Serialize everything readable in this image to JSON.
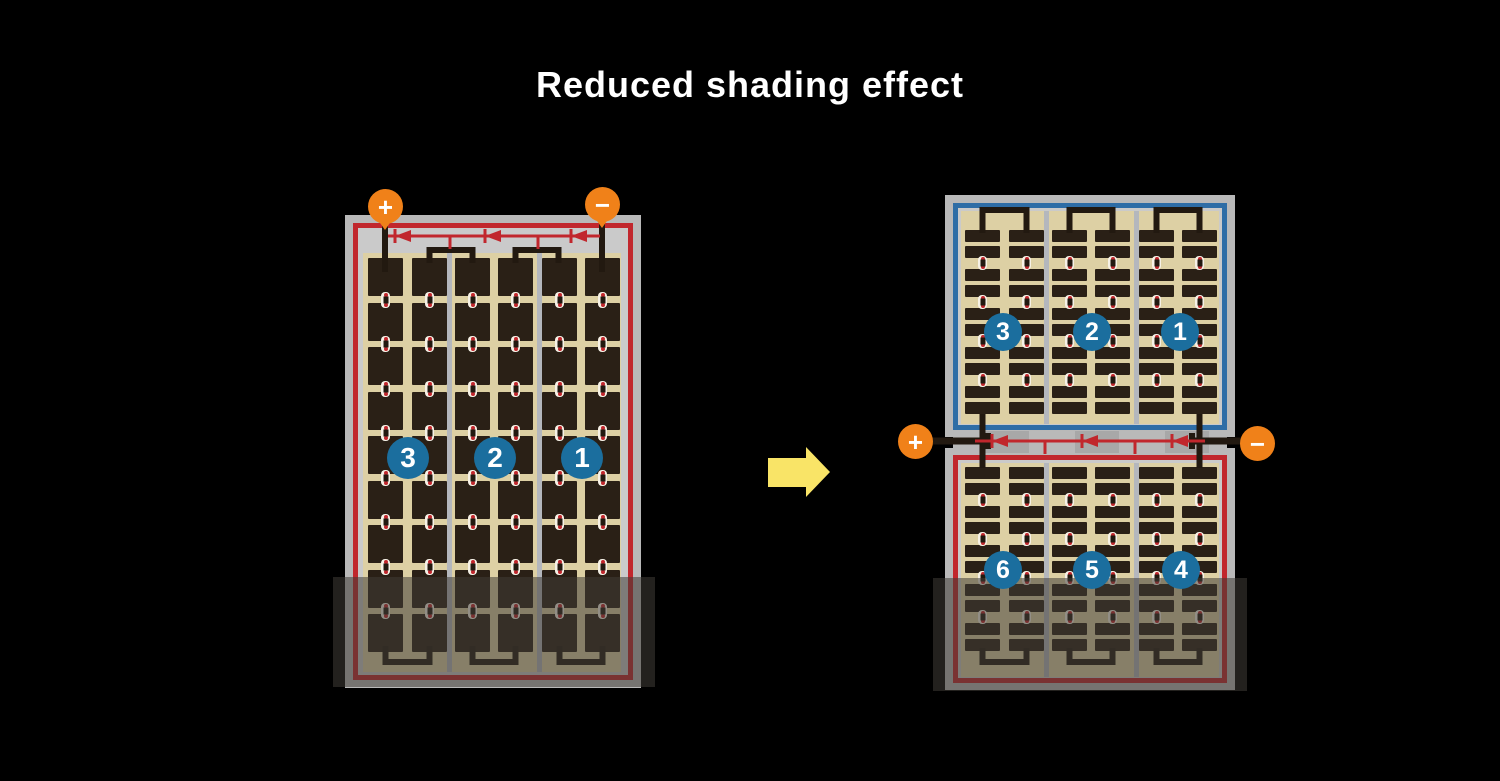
{
  "title": "Reduced shading effect",
  "colors": {
    "bg": "#000000",
    "title": "#ffffff",
    "frame": "#b9b9b9",
    "inner": "#cacaca",
    "tan": "#ddd0a4",
    "cell": "#2a2016",
    "divider": "#b4b7bd",
    "red": "#c1272d",
    "blue": "#2e6da6",
    "orange": "#f08119",
    "badge": "#1b6e9e",
    "yellow": "#f9e467",
    "wire": "#221910",
    "dot_white": "#f6f1e6",
    "junction_box": "#a8a8a8",
    "shadow": "rgba(64,60,54,0.55)"
  },
  "left_panel": {
    "terminals": [
      {
        "label": "+"
      },
      {
        "label": "−"
      }
    ],
    "strings": [
      {
        "number": "3"
      },
      {
        "number": "2"
      },
      {
        "number": "1"
      }
    ],
    "diode_count": 3,
    "shaded": true
  },
  "arrow": {
    "direction": "right"
  },
  "right_panel": {
    "terminals": [
      {
        "label": "+"
      },
      {
        "label": "−"
      }
    ],
    "top_module": {
      "border": "blue",
      "strings": [
        {
          "number": "3"
        },
        {
          "number": "2"
        },
        {
          "number": "1"
        }
      ]
    },
    "bottom_module": {
      "border": "red",
      "strings": [
        {
          "number": "6"
        },
        {
          "number": "5"
        },
        {
          "number": "4"
        }
      ]
    },
    "diode_count": 3,
    "shaded": true
  }
}
